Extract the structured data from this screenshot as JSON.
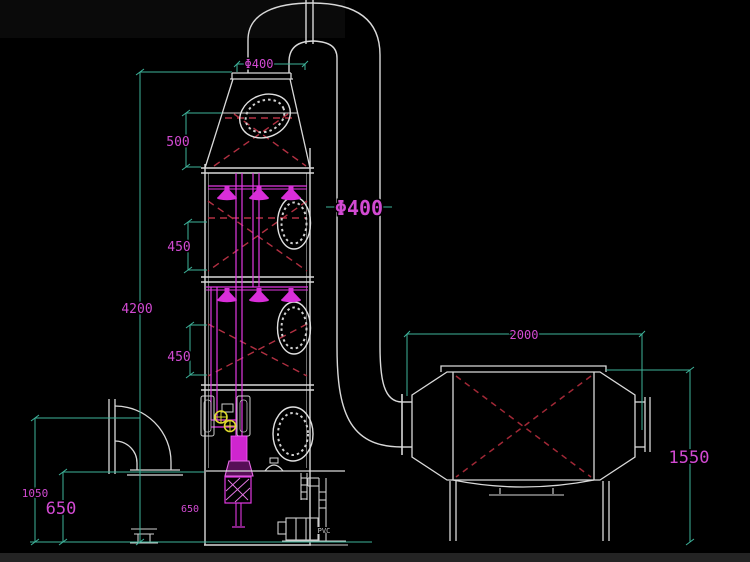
{
  "drawing": {
    "type": "cad-elevation",
    "equipment": [
      "spray-scrubber-tower",
      "gooseneck-duct",
      "filter-box",
      "recirculation-pump",
      "inlet-elbow"
    ]
  },
  "colors": {
    "background": "#000000",
    "dimension_line": "#3eb39a",
    "dimension_text": "#d24ad2",
    "equipment_line": "#d9d9d9",
    "packing_cross": "#b23042",
    "spray_pipe": "#e238e2",
    "valve_handle": "#ddd82e"
  },
  "dims": {
    "hood_outlet_dia": "Φ400",
    "duct_dia": "Φ400",
    "demister_h": "500",
    "packing1_h": "450",
    "packing2_h": "450",
    "tower_h": "4200",
    "inlet_h": "1050",
    "tank_h": "650",
    "tank_h_small": "650",
    "box_w": "2000",
    "box_h": "1550"
  },
  "labels": {
    "pump_material": "PVC"
  }
}
